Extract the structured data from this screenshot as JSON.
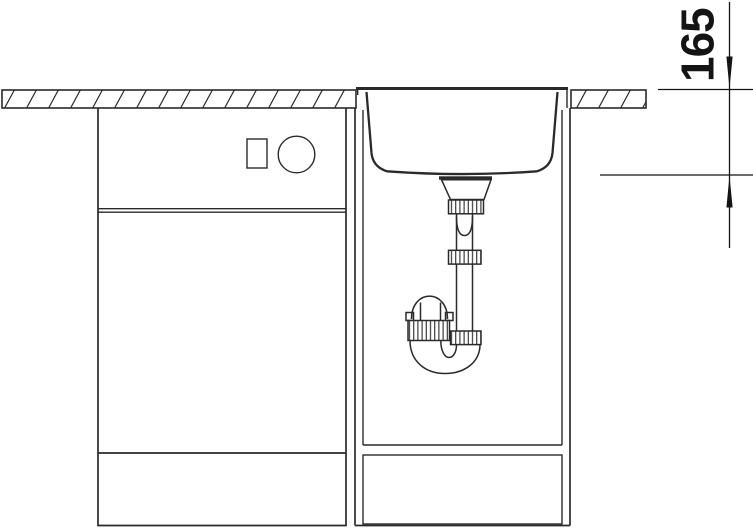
{
  "diagram": {
    "kind": "sink-installation-section-drawing",
    "dimension_label": {
      "value": "165",
      "orientation": "vertical-rotated"
    },
    "colors": {
      "background": "#ffffff",
      "line": "#2a2a2a",
      "dimension": "#141414"
    },
    "parts": [
      "worktop-left-hatched",
      "worktop-right-hatched",
      "base-cabinet-left",
      "cabinet-front-square-detail",
      "cabinet-front-circle-detail",
      "sink-base-cabinet",
      "sink-cabinet-plinth-panel",
      "inset-sink-bowl",
      "drain-flange",
      "drain-tailpiece-funnel",
      "union-nut",
      "standpipe",
      "p-trap-u-bend",
      "trap-riser-cap"
    ]
  }
}
